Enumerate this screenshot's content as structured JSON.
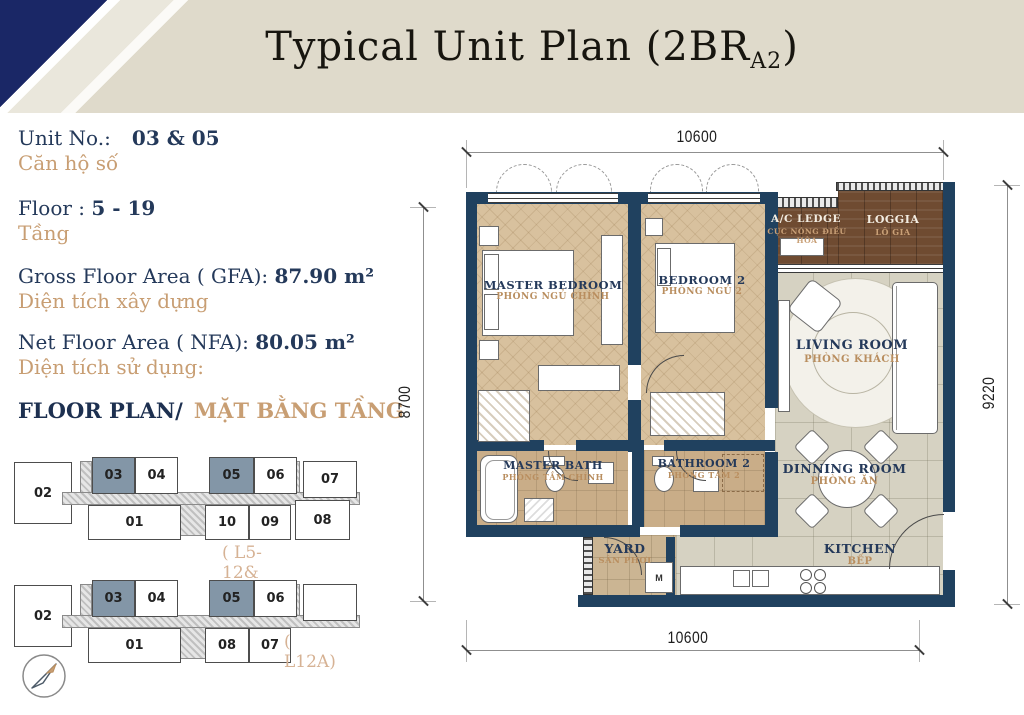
{
  "header": {
    "title_prefix": "Typical Unit Plan (2BR",
    "title_sub": "A2",
    "title_suffix": ")"
  },
  "info": {
    "unit_label": "Unit No.:",
    "unit_value": "03 & 05",
    "unit_vi": "Căn hộ số",
    "floor_label": "Floor : ",
    "floor_value": "5 - 19",
    "floor_vi": "Tầng",
    "gfa_label": "Gross Floor Area ( GFA): ",
    "gfa_value": "87.90 m²",
    "gfa_vi": "Diện tích xây dựng",
    "nfa_label": "Net Floor Area ( NFA): ",
    "nfa_value": "80.05 m²",
    "nfa_vi": "Diện tích sử dụng:",
    "floorplan_label": "FLOOR PLAN/",
    "floorplan_vi": "MẶT BẰNG TẦNG"
  },
  "keyplans": [
    {
      "caption": "( L5-12& L12B-19)",
      "left_unit": "02",
      "top_units": [
        "03",
        "04",
        "05",
        "06",
        "07"
      ],
      "bottom_units": [
        "01",
        "10",
        "09",
        "08"
      ],
      "highlighted": [
        "03",
        "05"
      ]
    },
    {
      "caption": "( L12A)",
      "left_unit": "02",
      "top_units": [
        "03",
        "04",
        "05",
        "06"
      ],
      "bottom_units": [
        "01",
        "08",
        "07"
      ],
      "highlighted": [
        "03",
        "05"
      ]
    }
  ],
  "plan": {
    "rooms": [
      {
        "name": "MASTER BEDROOM",
        "vi": "PHÒNG NGỦ CHÍNH"
      },
      {
        "name": "BEDROOM 2",
        "vi": "PHÒNG NGỦ 2"
      },
      {
        "name": "A/C LEDGE",
        "vi": "CỤC NÓNG ĐIỀU HÒA"
      },
      {
        "name": "LOGGIA",
        "vi": "LÔ GIA"
      },
      {
        "name": "LIVING ROOM",
        "vi": "PHÒNG KHÁCH"
      },
      {
        "name": "MASTER BATH",
        "vi": "PHÒNG TẮM CHÍNH"
      },
      {
        "name": "BATHROOM 2",
        "vi": "PHÒNG TẮM 2"
      },
      {
        "name": "DINNING ROOM",
        "vi": "PHÒNG ĂN"
      },
      {
        "name": "YARD",
        "vi": "SÂN PHƠI"
      },
      {
        "name": "KITCHEN",
        "vi": "BẾP"
      }
    ],
    "dimensions": {
      "top": "10600",
      "bottom": "10600",
      "left": "8700",
      "right": "9220"
    },
    "washer_label": "M"
  },
  "colors": {
    "header_bg": "#dfdacb",
    "navy_triangle": "#1a2766",
    "navy_text": "#24395a",
    "tan_text": "#c89e73",
    "wall_navy": "#20415f",
    "bedroom_floor": "#d8c19e",
    "tile_floor": "#d6d2c2",
    "bath_floor": "#c9ad88",
    "loggia_brown": "#6f4b31",
    "keyplan_highlight": "#8396a7"
  }
}
